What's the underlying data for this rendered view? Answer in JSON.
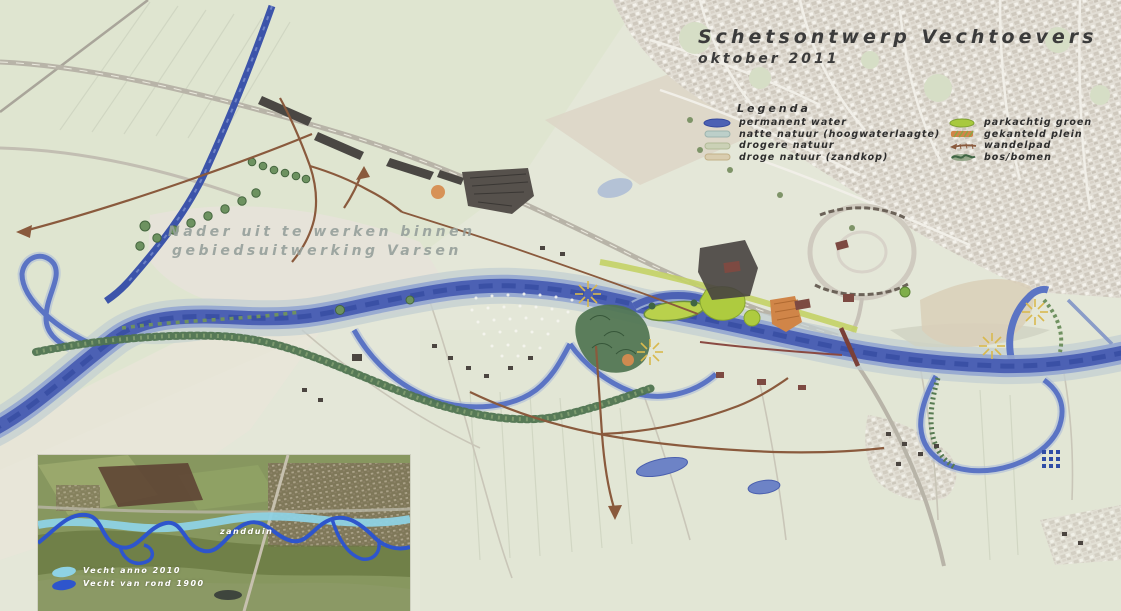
{
  "title": {
    "main": "Schetsontwerp Vechtoevers",
    "date": "oktober 2011"
  },
  "legend": {
    "heading": "Legenda",
    "left": [
      {
        "label": "permanent water",
        "color": "#4c61b4"
      },
      {
        "label": "natte natuur (hoogwaterlaagte)",
        "color": "#bccfc9"
      },
      {
        "label": "drogere natuur",
        "color": "#cbd1b6"
      },
      {
        "label": "droge natuur (zandkop)",
        "color": "#d9cdaf"
      }
    ],
    "right": [
      {
        "label": "parkachtig groen",
        "color": "#a8c93e"
      },
      {
        "label": "gekanteld plein",
        "color": "#d08548"
      },
      {
        "label": "wandelpad",
        "color": "#8a5a3d"
      },
      {
        "label": "bos/bomen",
        "color": "#4f7450"
      }
    ]
  },
  "map_note": {
    "line1": "Nader uit te werken binnen",
    "line2": "gebiedsuitwerking Varsen"
  },
  "inset": {
    "zandduin_label": "zandduin",
    "legend": [
      {
        "label": "Vecht anno 2010",
        "color": "#8ed2e4"
      },
      {
        "label": "Vecht van rond 1900",
        "color": "#2e55cc"
      }
    ]
  },
  "map_colors": {
    "river": "#4c61b4",
    "canal": "#3c54aa",
    "park_green": "#a8c93e",
    "path_brown": "#8a5a3d",
    "plein_orange": "#d08548",
    "bos_green": "#4f7450"
  }
}
